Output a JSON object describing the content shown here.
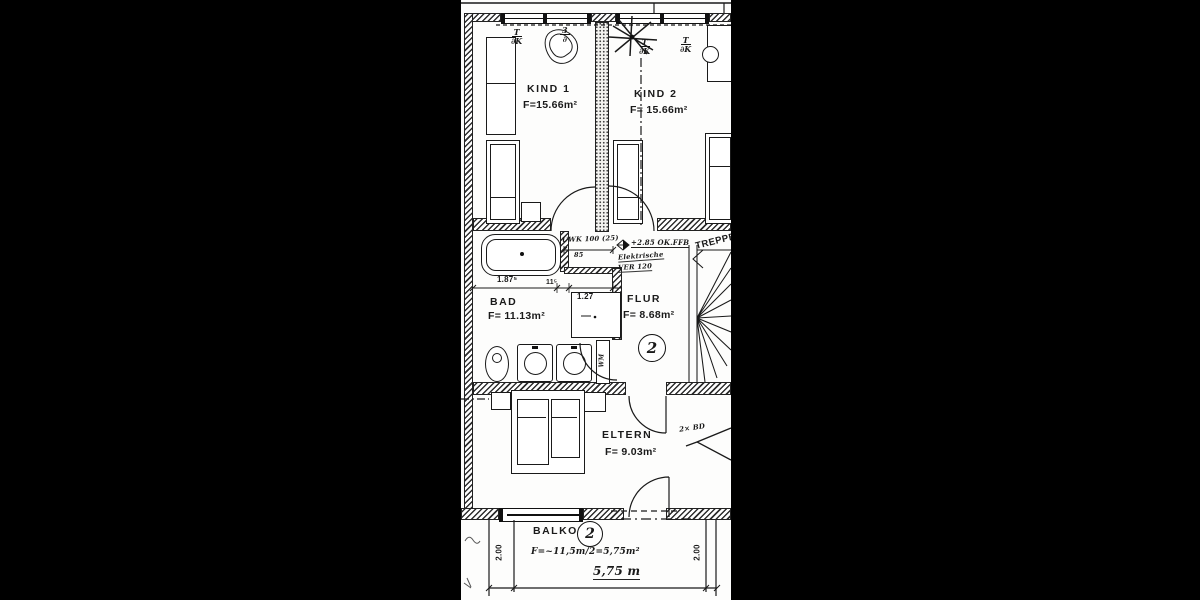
{
  "colors": {
    "ink": "#1a1a1a",
    "paper": "#fdfdfc",
    "frame": "#000000"
  },
  "rooms": [
    {
      "name": "KIND 1",
      "area": "F=15.66m²"
    },
    {
      "name": "KIND 2",
      "area": "F= 15.66m²"
    },
    {
      "name": "BAD",
      "area": "F= 11.13m²"
    },
    {
      "name": "FLUR",
      "area": "F= 8.68m²"
    },
    {
      "name": "ELTERN",
      "area": "F= 9.03m²"
    },
    {
      "name": "BALKON",
      "area": "F=~11,5m/2=5,75m²"
    },
    {
      "name": "TREPPE",
      "area": ""
    }
  ],
  "dimensions": {
    "bath_width": "1.87⁵",
    "wall": "11⁵",
    "niche": "1.27",
    "seg85": "85",
    "balcony_depth_left": "2.00",
    "balcony_depth_right": "2.00",
    "balcony_width": "5,75 m"
  },
  "annotations": {
    "uwk": "UWK 100 (25)",
    "level": "+2.85 OK.FFB",
    "elektro_line1": "Elektrische",
    "elektro_line2": "VER 120",
    "note": "2× BD",
    "washing_machine": "WM",
    "flur_circle": "2",
    "balkon_circle": "2"
  },
  "symbols": {
    "tbk": [
      {
        "top": "T",
        "bottom": "∂K"
      },
      {
        "top": "3",
        "bottom": "∂"
      },
      {
        "top": "T",
        "bottom": "∂K"
      },
      {
        "top": "T",
        "bottom": "∂K"
      }
    ]
  }
}
